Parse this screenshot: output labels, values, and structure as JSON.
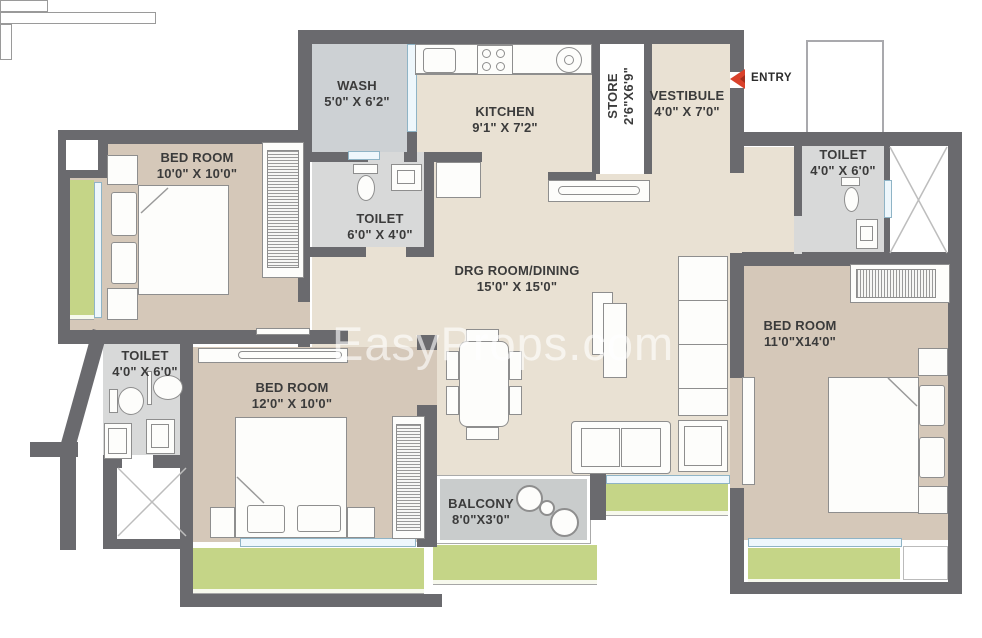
{
  "watermark": "EasyProps.com",
  "entry_label": "ENTRY",
  "rooms": [
    {
      "name": "WASH",
      "dims": "5'0\" X 6'2\""
    },
    {
      "name": "KITCHEN",
      "dims": "9'1\" X 7'2\""
    },
    {
      "name": "STORE",
      "dims": "2'6\"X6'9\""
    },
    {
      "name": "VESTIBULE",
      "dims": "4'0\" X 7'0\""
    },
    {
      "name": "TOILET",
      "dims": "4'0\" X 6'0\""
    },
    {
      "name": "BED ROOM",
      "dims": "10'0\" X 10'0\""
    },
    {
      "name": "TOILET",
      "dims": "6'0\" X 4'0\""
    },
    {
      "name": "DRG ROOM/DINING",
      "dims": "15'0\" X 15'0\""
    },
    {
      "name": "BED ROOM",
      "dims": "11'0\"X14'0\""
    },
    {
      "name": "TOILET",
      "dims": "4'0\" X 6'0\""
    },
    {
      "name": "BED ROOM",
      "dims": "12'0\" X 10'0\""
    },
    {
      "name": "BALCONY",
      "dims": "8'0\"X3'0\""
    }
  ],
  "colors": {
    "wall": "#6a6a6e",
    "room_beige": "#e9e1d3",
    "room_tan": "#d5c8b9",
    "toilet_gray": "#d8d9d9",
    "wash_gray": "#cdd1d4",
    "balcony_gray": "#c9cccc",
    "garden_green": "#c5d587",
    "window_blue": "#eef7fc",
    "entry_red": "#d9412b",
    "label_text": "#3b3b3b"
  }
}
